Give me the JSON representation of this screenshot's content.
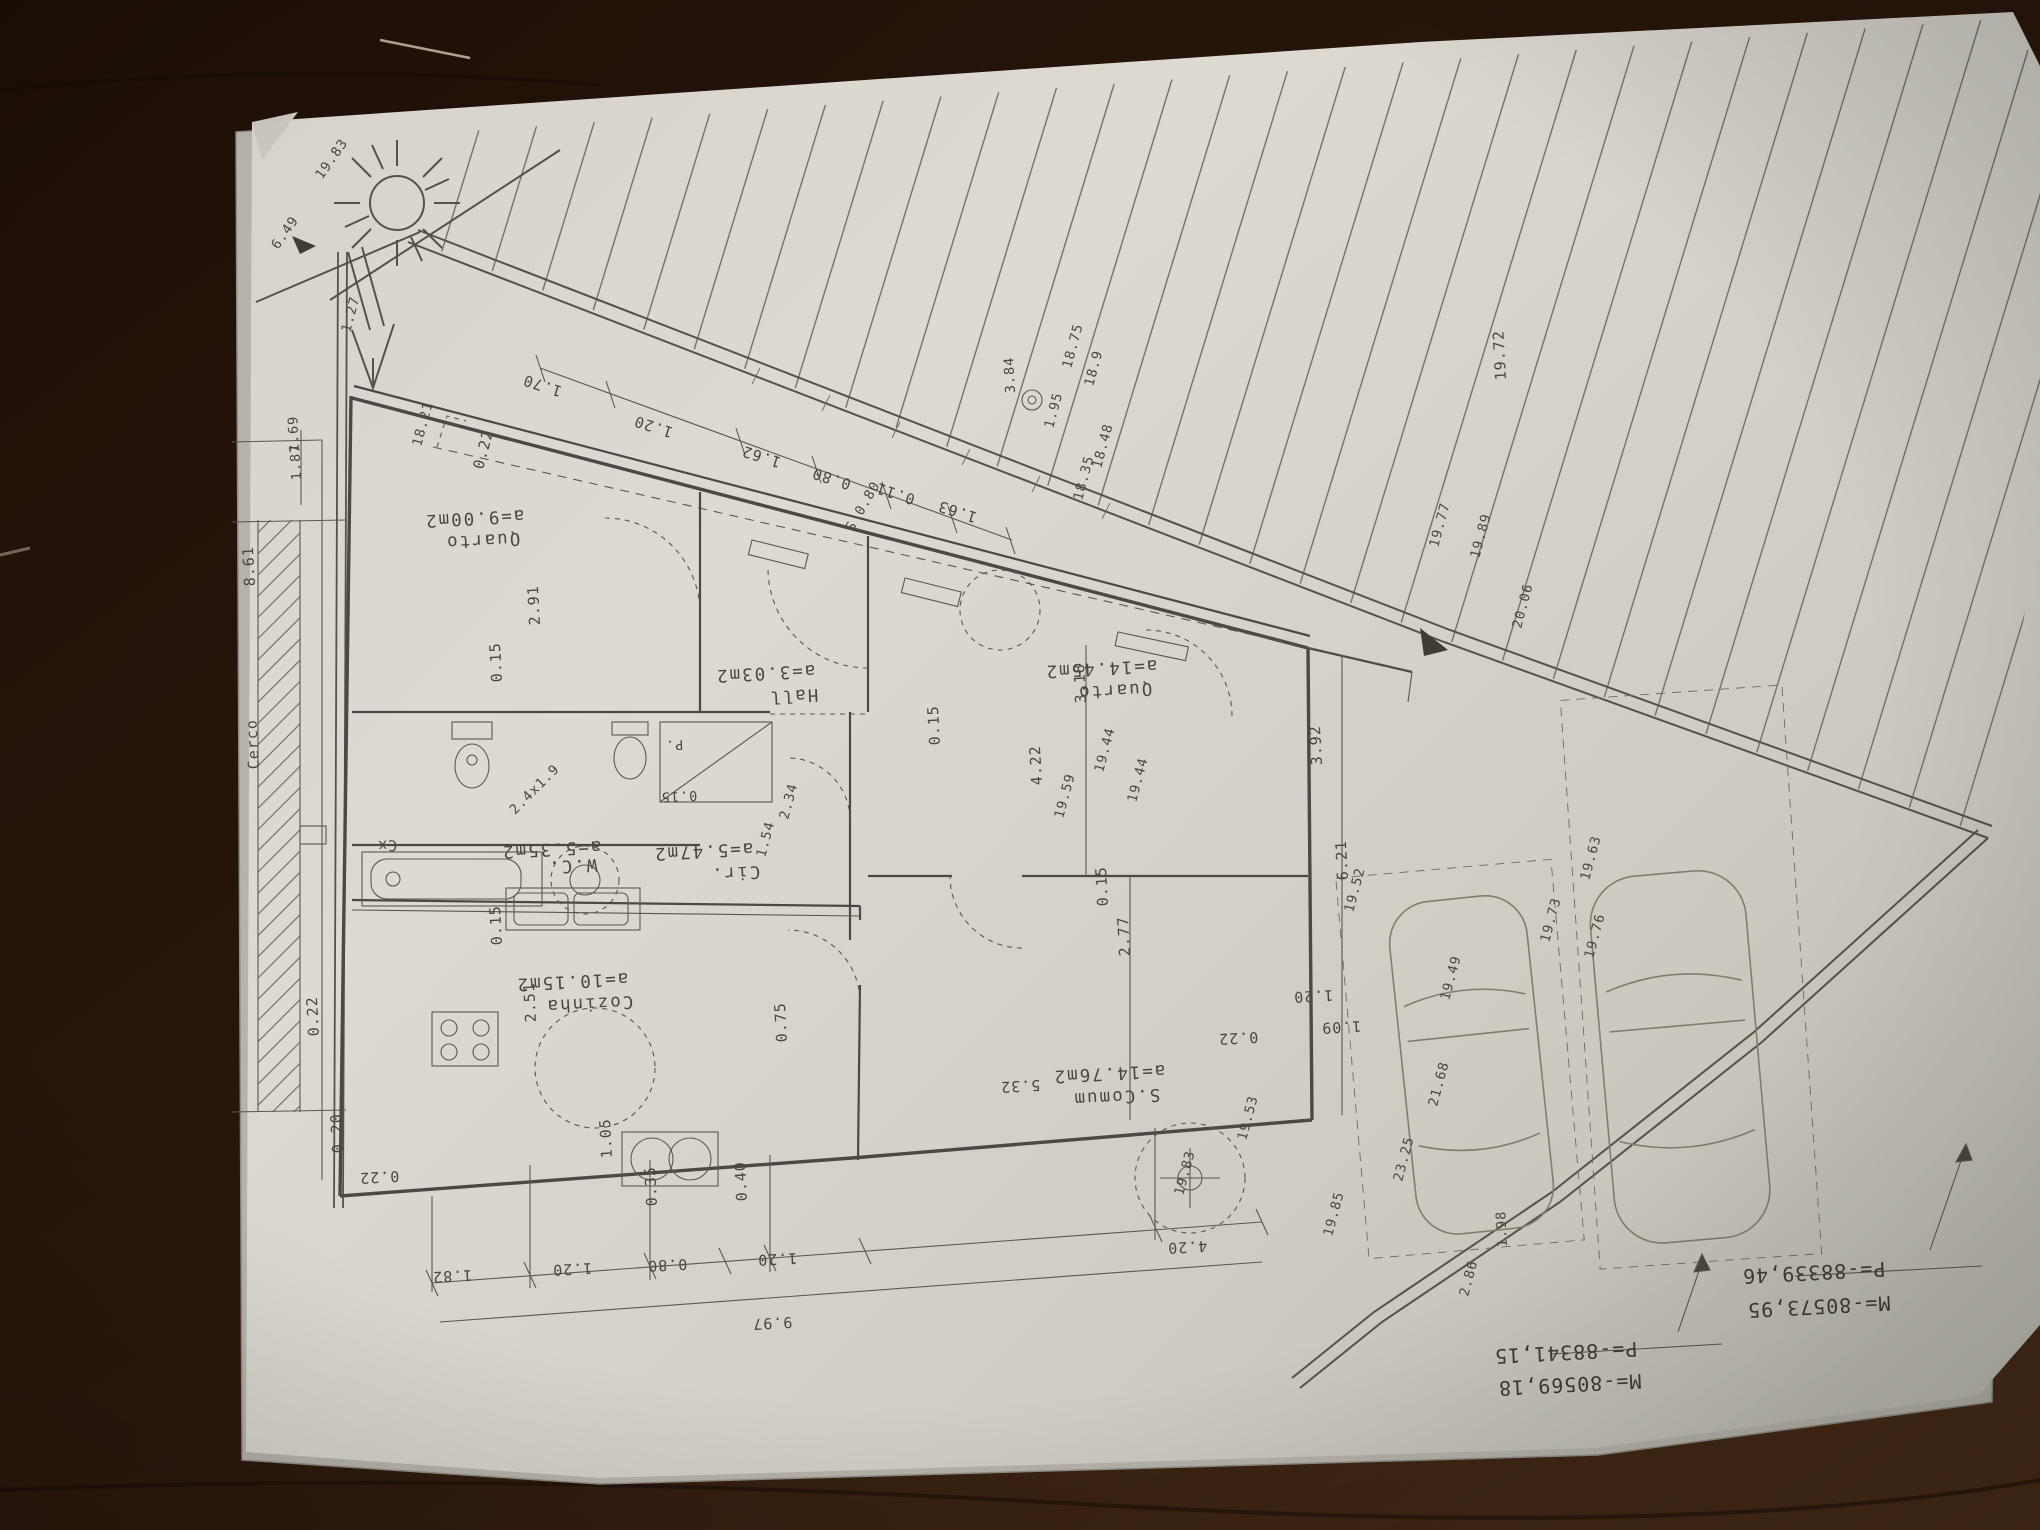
{
  "rooms": [
    {
      "name": "Quarto",
      "area": "a=9.00m2"
    },
    {
      "name": "Hall",
      "area": "a=3.03m2"
    },
    {
      "name": "Quarto",
      "area": "a=14.45m2"
    },
    {
      "name": "W.C.",
      "area": "a=5.35m2"
    },
    {
      "name": "Cir.",
      "area": "a=5.47m2"
    },
    {
      "name": "Cozinha",
      "area": "a=10.15m2"
    },
    {
      "name": "S.Comum",
      "area": "a=14.76m2"
    }
  ],
  "survey_coords": {
    "point_a": {
      "m": "M=-80573,95",
      "p": "P=-88339,46"
    },
    "point_b": {
      "m": "M=-80569,18",
      "p": "P=-88341,15"
    }
  },
  "dimensions": {
    "top_chain": [
      "1.70",
      "1.20",
      "1.62",
      "0.80",
      "0.11",
      "1.63"
    ],
    "top_left": [
      "19.83",
      "6.49",
      "1.27",
      "18.21",
      "0.22",
      "1.69",
      "1.87"
    ],
    "street": [
      "18.75",
      "18.9",
      "18.48",
      "18.35",
      "1.95",
      "3.84",
      "19.72",
      "19.77",
      "19.89",
      "20.06"
    ],
    "left": [
      "8.61",
      "Cerco",
      "Cx",
      "0.22",
      "0.20",
      "0.22"
    ],
    "interior": [
      "2.91",
      "0.15",
      "0.15",
      "2.51",
      "0.75",
      "1.05",
      "5.32",
      "0.22",
      "0.15",
      "3.18",
      "4.22",
      "3.92",
      "6.21",
      "2.77",
      "0.15",
      "1.20",
      "1.09",
      "2.4x1.9",
      "2.34",
      "1.54",
      "0.15",
      "S 0.80",
      "P."
    ],
    "yard": [
      "19.44",
      "19.44",
      "19.59",
      "19.52",
      "19.49",
      "19.63",
      "19.73",
      "19.76",
      "19.53",
      "19.83",
      "19.85",
      "23.25",
      "21.68",
      "1.98",
      "2.86"
    ],
    "bottom_chain": [
      "0.35",
      "0.40",
      "1.82",
      "1.20",
      "0.80",
      "1.20",
      "4.20",
      "9.97"
    ]
  }
}
